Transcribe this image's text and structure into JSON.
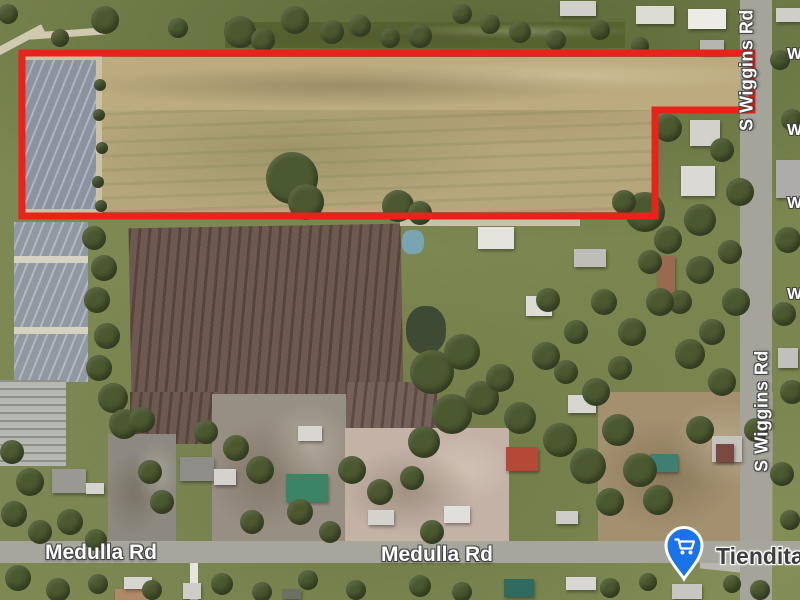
{
  "map": {
    "road_labels": [
      {
        "text": "S Wiggins Rd"
      },
      {
        "text": "S Wiggins Rd"
      },
      {
        "text": "Medulla Rd"
      },
      {
        "text": "Medulla Rd"
      }
    ],
    "edge_labels": [
      {
        "text": "W"
      },
      {
        "text": "W"
      },
      {
        "text": "W"
      },
      {
        "text": "W"
      }
    ],
    "poi": {
      "label": "Tiendita",
      "icon": "shopping-cart-icon",
      "pin_color": "#1a73e8",
      "pin_outline": "#ffffff"
    },
    "parcel": {
      "outline_color": "#e8231c",
      "outline_width": 7,
      "points": "22,53 752,53 752,110 655,110 655,216 22,216"
    }
  },
  "scenery": {
    "fields": [
      {
        "x": 225,
        "y": 22,
        "w": 400,
        "h": 26,
        "c": "#55632f",
        "tex": "mottle"
      },
      {
        "x": 96,
        "y": 57,
        "w": 561,
        "h": 155,
        "c": "#b6a67c",
        "tex": "tan"
      },
      {
        "x": 96,
        "y": 57,
        "w": 654,
        "h": 53,
        "c": "#bcab7f",
        "tex": "mottle"
      },
      {
        "x": 20,
        "y": 56,
        "w": 82,
        "h": 157,
        "c": "#cbc2a6"
      },
      {
        "x": 24,
        "y": 60,
        "w": 72,
        "h": 149,
        "c": "#8b93a0",
        "tex": "rows-a"
      },
      {
        "x": 14,
        "y": 222,
        "w": 74,
        "h": 160,
        "c": "#9099a2",
        "tex": "rows-a"
      },
      {
        "x": 14,
        "y": 256,
        "w": 74,
        "h": 7,
        "c": "#d6d2c2"
      },
      {
        "x": 14,
        "y": 327,
        "w": 74,
        "h": 7,
        "c": "#d6d2c2"
      },
      {
        "x": 0,
        "y": 380,
        "w": 66,
        "h": 86,
        "c": "#b5b8b0",
        "tex": "rows-h"
      },
      {
        "x": 130,
        "y": 226,
        "w": 272,
        "h": 172,
        "c": "#6d5950",
        "tex": "rows-b",
        "rot": -1
      },
      {
        "x": 130,
        "y": 392,
        "w": 88,
        "h": 52,
        "c": "#6d5950",
        "tex": "rows-b"
      },
      {
        "x": 345,
        "y": 382,
        "w": 92,
        "h": 50,
        "c": "#75615a",
        "tex": "rows-b"
      },
      {
        "x": 108,
        "y": 434,
        "w": 68,
        "h": 108,
        "c": "#8d8880",
        "tex": "mottle"
      },
      {
        "x": 212,
        "y": 394,
        "w": 134,
        "h": 148,
        "c": "#988f84",
        "tex": "mottle"
      },
      {
        "x": 345,
        "y": 428,
        "w": 164,
        "h": 116,
        "c": "#c4b2a7",
        "tex": "mottle"
      },
      {
        "x": 598,
        "y": 392,
        "w": 175,
        "h": 150,
        "c": "#a3906f",
        "tex": "mottle"
      },
      {
        "x": 406,
        "y": 306,
        "w": 40,
        "h": 48,
        "c": "#3f4a35",
        "rad": 45
      },
      {
        "x": 402,
        "y": 230,
        "w": 22,
        "h": 24,
        "c": "#79a4b2",
        "rad": 40
      },
      {
        "x": -6,
        "y": 36,
        "w": 52,
        "h": 8,
        "c": "#cfc9b0",
        "rot": -28
      },
      {
        "x": 30,
        "y": 30,
        "w": 75,
        "h": 7,
        "c": "#cfc9b0",
        "rot": -4
      },
      {
        "x": 400,
        "y": 219,
        "w": 180,
        "h": 7,
        "c": "#c9c2a8"
      },
      {
        "x": 190,
        "y": 562,
        "w": 8,
        "h": 38,
        "c": "#e6e6de"
      },
      {
        "x": 700,
        "y": 563,
        "w": 70,
        "h": 9,
        "c": "#b8b8ae",
        "rot": 6
      }
    ],
    "roads": [
      {
        "x": 740,
        "y": 0,
        "w": 32,
        "h": 600,
        "c": "#a4a49a"
      },
      {
        "x": 0,
        "y": 541,
        "w": 800,
        "h": 22,
        "c": "#a6a69c"
      }
    ],
    "houses": [
      [
        636,
        6,
        38,
        18,
        "#dcdcd4"
      ],
      [
        688,
        9,
        38,
        20,
        "#ecebe5"
      ],
      [
        560,
        1,
        36,
        15,
        "#d0cfc9"
      ],
      [
        700,
        40,
        24,
        14,
        "#b6b5af"
      ],
      [
        776,
        8,
        24,
        14,
        "#d0cec8"
      ],
      [
        690,
        120,
        30,
        26,
        "#d3d1cb"
      ],
      [
        681,
        166,
        34,
        30,
        "#dbd9d3"
      ],
      [
        776,
        160,
        26,
        38,
        "#aeacaa"
      ],
      [
        478,
        227,
        36,
        22,
        "#e5e3dd"
      ],
      [
        574,
        249,
        32,
        18,
        "#bfbdb7"
      ],
      [
        658,
        256,
        17,
        40,
        "#9a6a50"
      ],
      [
        526,
        296,
        26,
        20,
        "#dddbd5"
      ],
      [
        568,
        395,
        28,
        18,
        "#d7d5cf"
      ],
      [
        712,
        436,
        30,
        26,
        "#c5c3bd"
      ],
      [
        716,
        444,
        18,
        18,
        "#7a4a42"
      ],
      [
        650,
        454,
        28,
        18,
        "#3e7f72"
      ],
      [
        506,
        447,
        32,
        24,
        "#b44a36"
      ],
      [
        286,
        474,
        42,
        28,
        "#3b8465"
      ],
      [
        298,
        426,
        24,
        15,
        "#d8d6d0"
      ],
      [
        180,
        457,
        34,
        24,
        "#8f8d87"
      ],
      [
        214,
        469,
        22,
        16,
        "#d4d2cc"
      ],
      [
        52,
        469,
        34,
        24,
        "#9a9892"
      ],
      [
        86,
        483,
        18,
        11,
        "#d6d4ce"
      ],
      [
        368,
        510,
        26,
        15,
        "#d4d2cc"
      ],
      [
        444,
        506,
        26,
        17,
        "#e1dfd9"
      ],
      [
        556,
        511,
        22,
        13,
        "#ceccc6"
      ],
      [
        115,
        589,
        36,
        11,
        "#b08968"
      ],
      [
        124,
        577,
        28,
        12,
        "#d7d5cf"
      ],
      [
        183,
        583,
        18,
        16,
        "#ceccc6"
      ],
      [
        283,
        589,
        18,
        10,
        "#6b7062"
      ],
      [
        504,
        579,
        30,
        18,
        "#2e6b5e"
      ],
      [
        566,
        577,
        30,
        13,
        "#d9d7d1"
      ],
      [
        672,
        584,
        30,
        15,
        "#c8c6c0"
      ],
      [
        778,
        348,
        20,
        20,
        "#c2c0ba"
      ]
    ],
    "trees": [
      [
        105,
        20,
        14
      ],
      [
        240,
        32,
        16
      ],
      [
        263,
        40,
        12
      ],
      [
        295,
        20,
        14
      ],
      [
        332,
        32,
        12
      ],
      [
        360,
        26,
        11
      ],
      [
        390,
        38,
        10
      ],
      [
        420,
        36,
        12
      ],
      [
        462,
        14,
        10
      ],
      [
        490,
        24,
        10
      ],
      [
        520,
        32,
        11
      ],
      [
        556,
        40,
        10
      ],
      [
        600,
        30,
        10
      ],
      [
        640,
        46,
        9
      ],
      [
        178,
        28,
        10
      ],
      [
        60,
        38,
        9
      ],
      [
        8,
        14,
        10
      ],
      [
        292,
        178,
        26
      ],
      [
        306,
        202,
        18
      ],
      [
        398,
        206,
        16
      ],
      [
        420,
        213,
        12
      ],
      [
        645,
        212,
        20
      ],
      [
        624,
        202,
        12
      ],
      [
        100,
        85,
        6
      ],
      [
        99,
        115,
        6
      ],
      [
        102,
        148,
        6
      ],
      [
        98,
        182,
        6
      ],
      [
        101,
        206,
        6
      ],
      [
        94,
        238,
        12
      ],
      [
        104,
        268,
        13
      ],
      [
        97,
        300,
        13
      ],
      [
        107,
        336,
        13
      ],
      [
        99,
        368,
        13
      ],
      [
        113,
        398,
        15
      ],
      [
        124,
        424,
        15
      ],
      [
        142,
        420,
        13
      ],
      [
        668,
        128,
        14
      ],
      [
        722,
        150,
        12
      ],
      [
        740,
        192,
        14
      ],
      [
        700,
        220,
        16
      ],
      [
        668,
        240,
        14
      ],
      [
        730,
        252,
        12
      ],
      [
        700,
        270,
        14
      ],
      [
        736,
        302,
        14
      ],
      [
        712,
        332,
        13
      ],
      [
        690,
        354,
        15
      ],
      [
        722,
        382,
        14
      ],
      [
        650,
        262,
        12
      ],
      [
        680,
        302,
        12
      ],
      [
        788,
        240,
        13
      ],
      [
        784,
        314,
        12
      ],
      [
        792,
        392,
        12
      ],
      [
        782,
        474,
        12
      ],
      [
        790,
        520,
        10
      ],
      [
        780,
        60,
        10
      ],
      [
        792,
        120,
        11
      ],
      [
        432,
        372,
        22
      ],
      [
        462,
        352,
        18
      ],
      [
        452,
        414,
        20
      ],
      [
        482,
        398,
        17
      ],
      [
        424,
        442,
        16
      ],
      [
        500,
        378,
        14
      ],
      [
        520,
        418,
        16
      ],
      [
        546,
        356,
        14
      ],
      [
        560,
        440,
        17
      ],
      [
        588,
        466,
        18
      ],
      [
        618,
        430,
        16
      ],
      [
        640,
        470,
        17
      ],
      [
        658,
        500,
        15
      ],
      [
        610,
        502,
        14
      ],
      [
        548,
        300,
        12
      ],
      [
        576,
        332,
        12
      ],
      [
        604,
        302,
        13
      ],
      [
        632,
        332,
        14
      ],
      [
        660,
        302,
        14
      ],
      [
        566,
        372,
        12
      ],
      [
        596,
        392,
        14
      ],
      [
        620,
        368,
        12
      ],
      [
        700,
        430,
        14
      ],
      [
        756,
        430,
        12
      ],
      [
        352,
        470,
        14
      ],
      [
        380,
        492,
        13
      ],
      [
        412,
        478,
        12
      ],
      [
        300,
        512,
        13
      ],
      [
        260,
        470,
        14
      ],
      [
        236,
        448,
        13
      ],
      [
        206,
        432,
        12
      ],
      [
        252,
        522,
        12
      ],
      [
        330,
        532,
        11
      ],
      [
        432,
        532,
        12
      ],
      [
        12,
        452,
        12
      ],
      [
        30,
        482,
        14
      ],
      [
        14,
        514,
        13
      ],
      [
        40,
        532,
        12
      ],
      [
        70,
        522,
        13
      ],
      [
        96,
        540,
        11
      ],
      [
        150,
        472,
        12
      ],
      [
        162,
        502,
        12
      ],
      [
        18,
        578,
        13
      ],
      [
        58,
        590,
        12
      ],
      [
        98,
        584,
        10
      ],
      [
        152,
        590,
        10
      ],
      [
        222,
        584,
        11
      ],
      [
        262,
        592,
        10
      ],
      [
        308,
        580,
        10
      ],
      [
        356,
        590,
        10
      ],
      [
        420,
        586,
        11
      ],
      [
        462,
        592,
        10
      ],
      [
        610,
        588,
        10
      ],
      [
        648,
        582,
        9
      ],
      [
        760,
        590,
        10
      ],
      [
        732,
        584,
        9
      ]
    ]
  }
}
